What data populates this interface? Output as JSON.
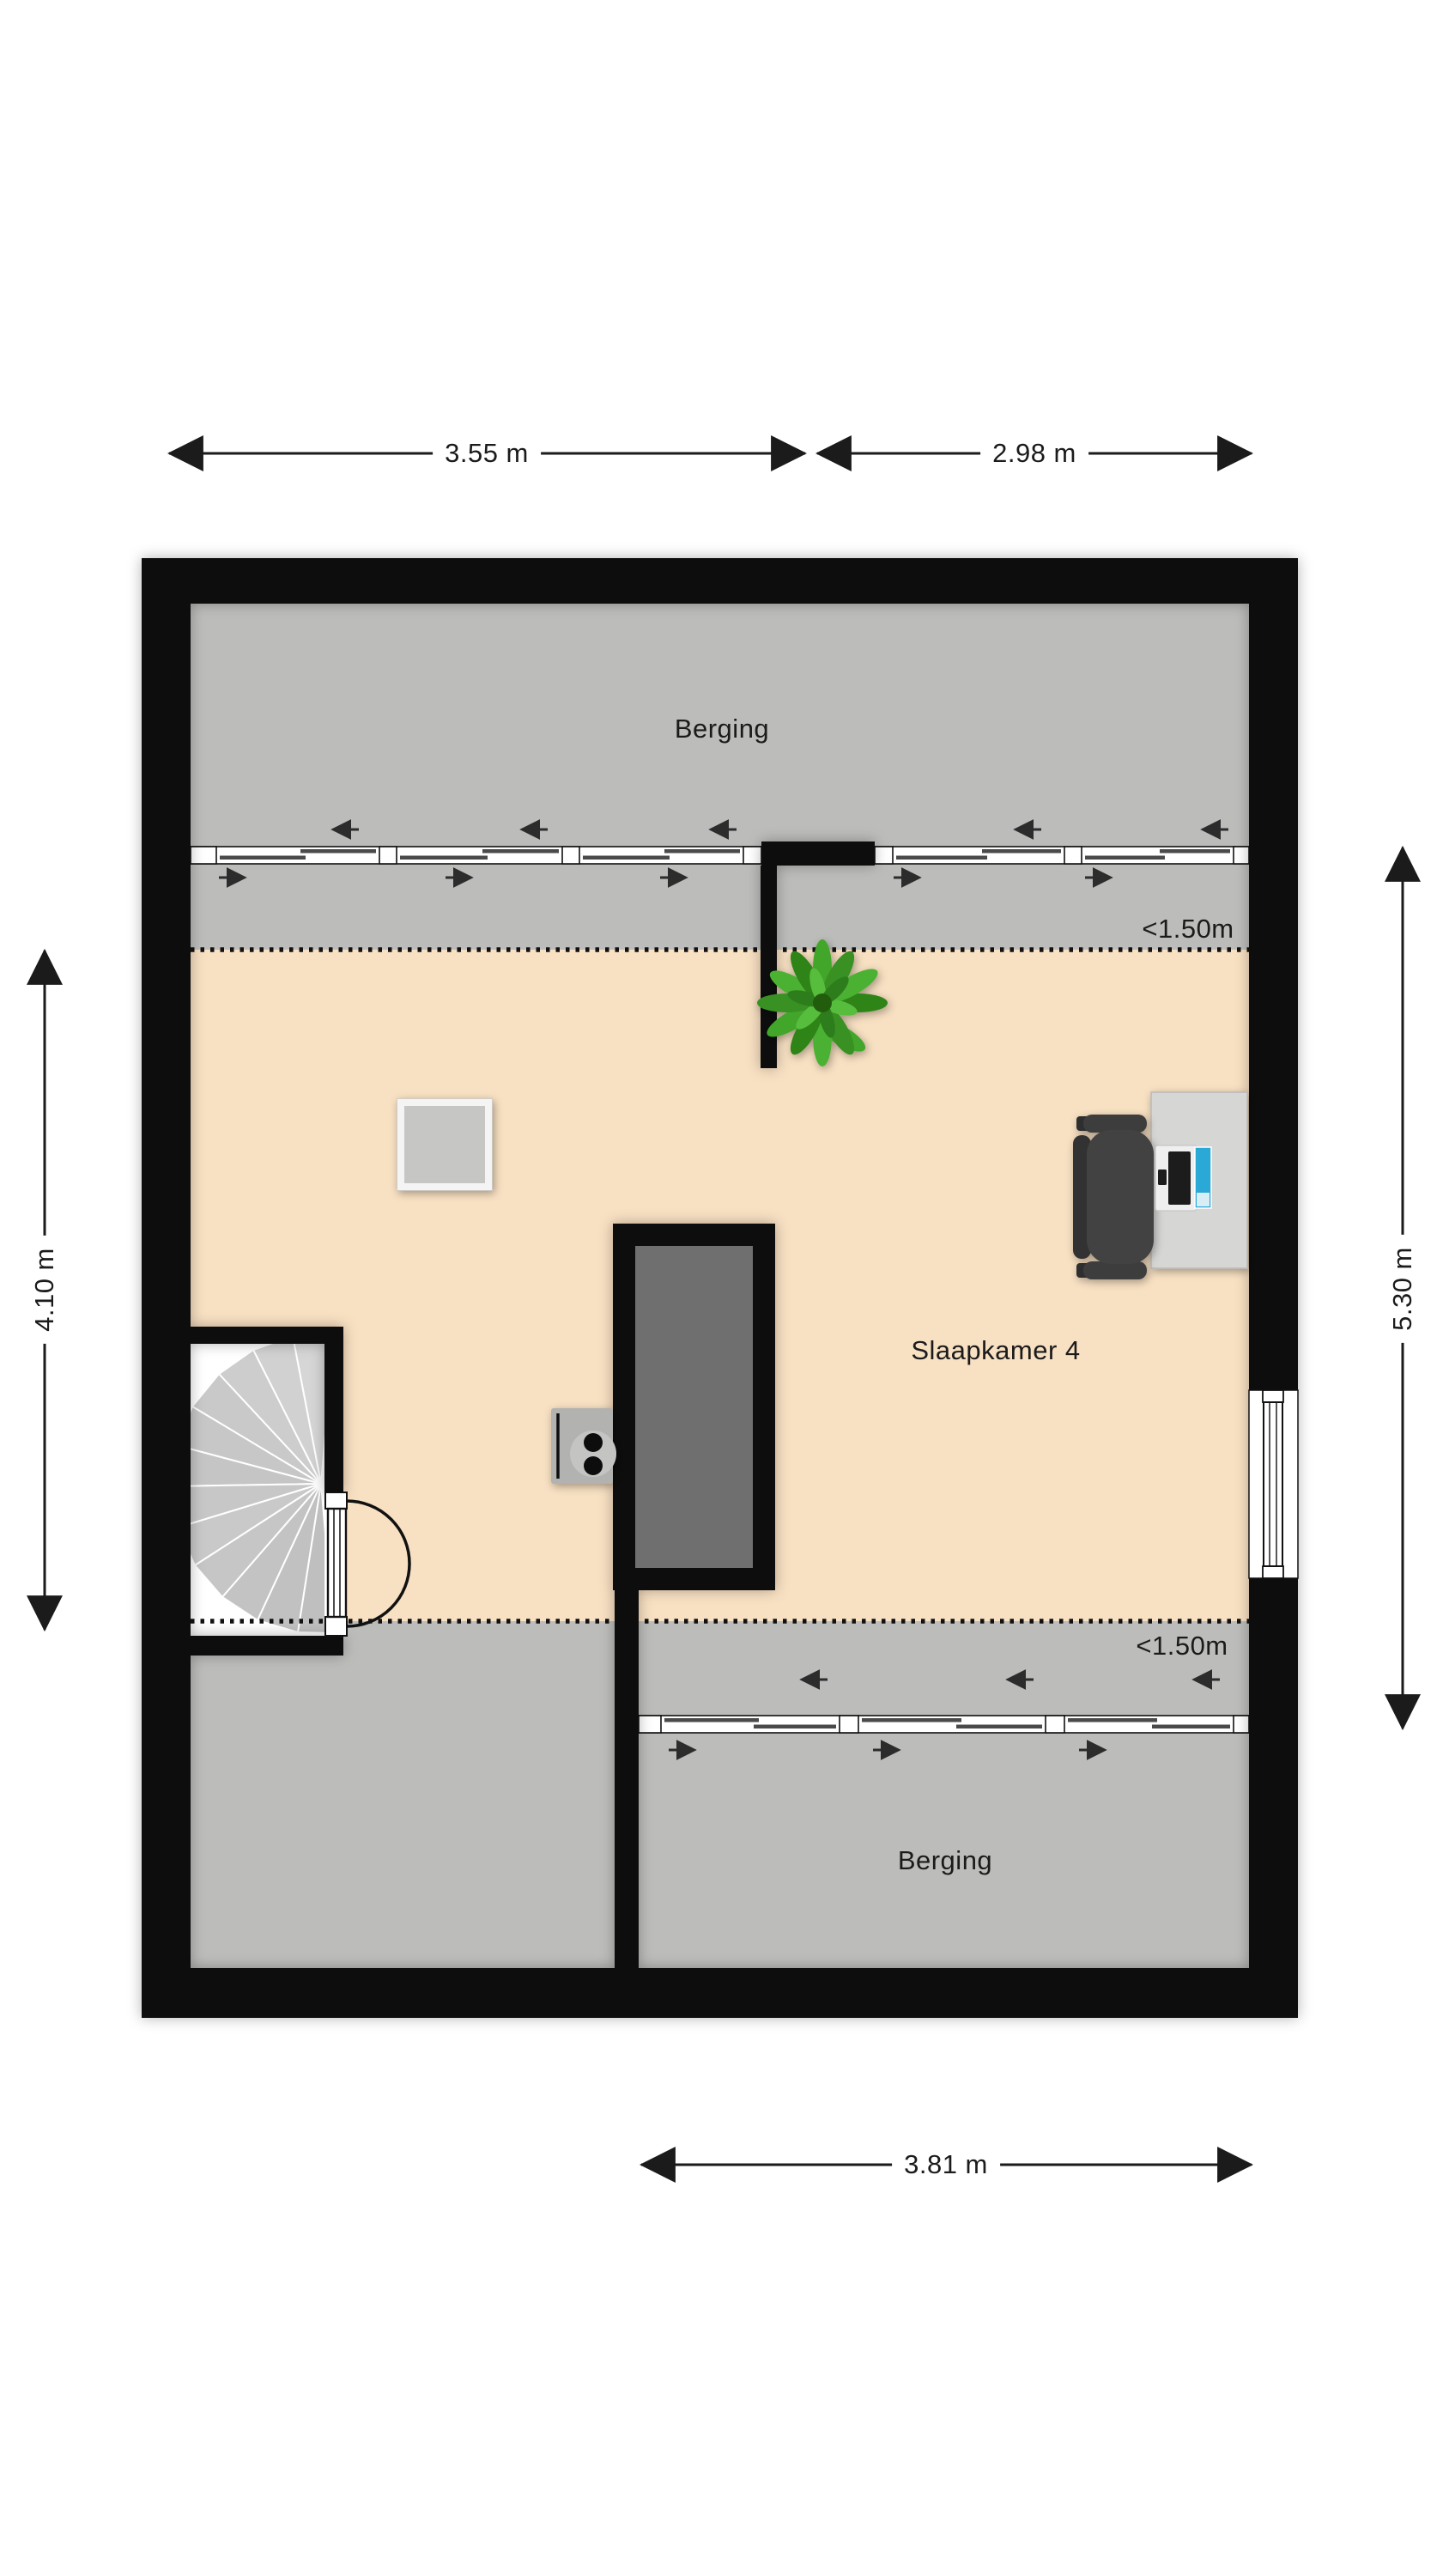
{
  "labels": {
    "storage_top": "Berging",
    "storage_bottom": "Berging",
    "bedroom": "Slaapkamer 4",
    "low_height_top": "<1.50m",
    "low_height_bottom": "<1.50m"
  },
  "dimensions": {
    "top_left": "3.55 m",
    "top_right": "2.98 m",
    "side_left": "4.10 m",
    "side_right": "5.30 m",
    "bottom": "3.81 m"
  },
  "colors": {
    "wall": "#0b0b0b",
    "storage_floor": "#bcbcba",
    "bedroom_floor": "#f8e0c2",
    "floor_void": "#6f6f6f",
    "stair_tread": "#c9c9c9",
    "desk": "#d6d6d4",
    "chair": "#3d3d3d",
    "monitor_screen": "#2aa8d6",
    "plant": "#3c9a27",
    "text": "#1b1b1b"
  },
  "icons": {
    "spiral_staircase": "spiral-staircase",
    "door_swing": "door-swing",
    "sliding_window_row": "sliding-window-row",
    "roof_slope_arrow": "roof-slope-arrow",
    "floor_void": "floor-void",
    "skylight": "skylight",
    "radiator_unit": "radiator-unit",
    "desk_with_laptop": "desk-laptop-monitor",
    "office_chair": "office-chair",
    "potted_plant": "potted-plant"
  }
}
